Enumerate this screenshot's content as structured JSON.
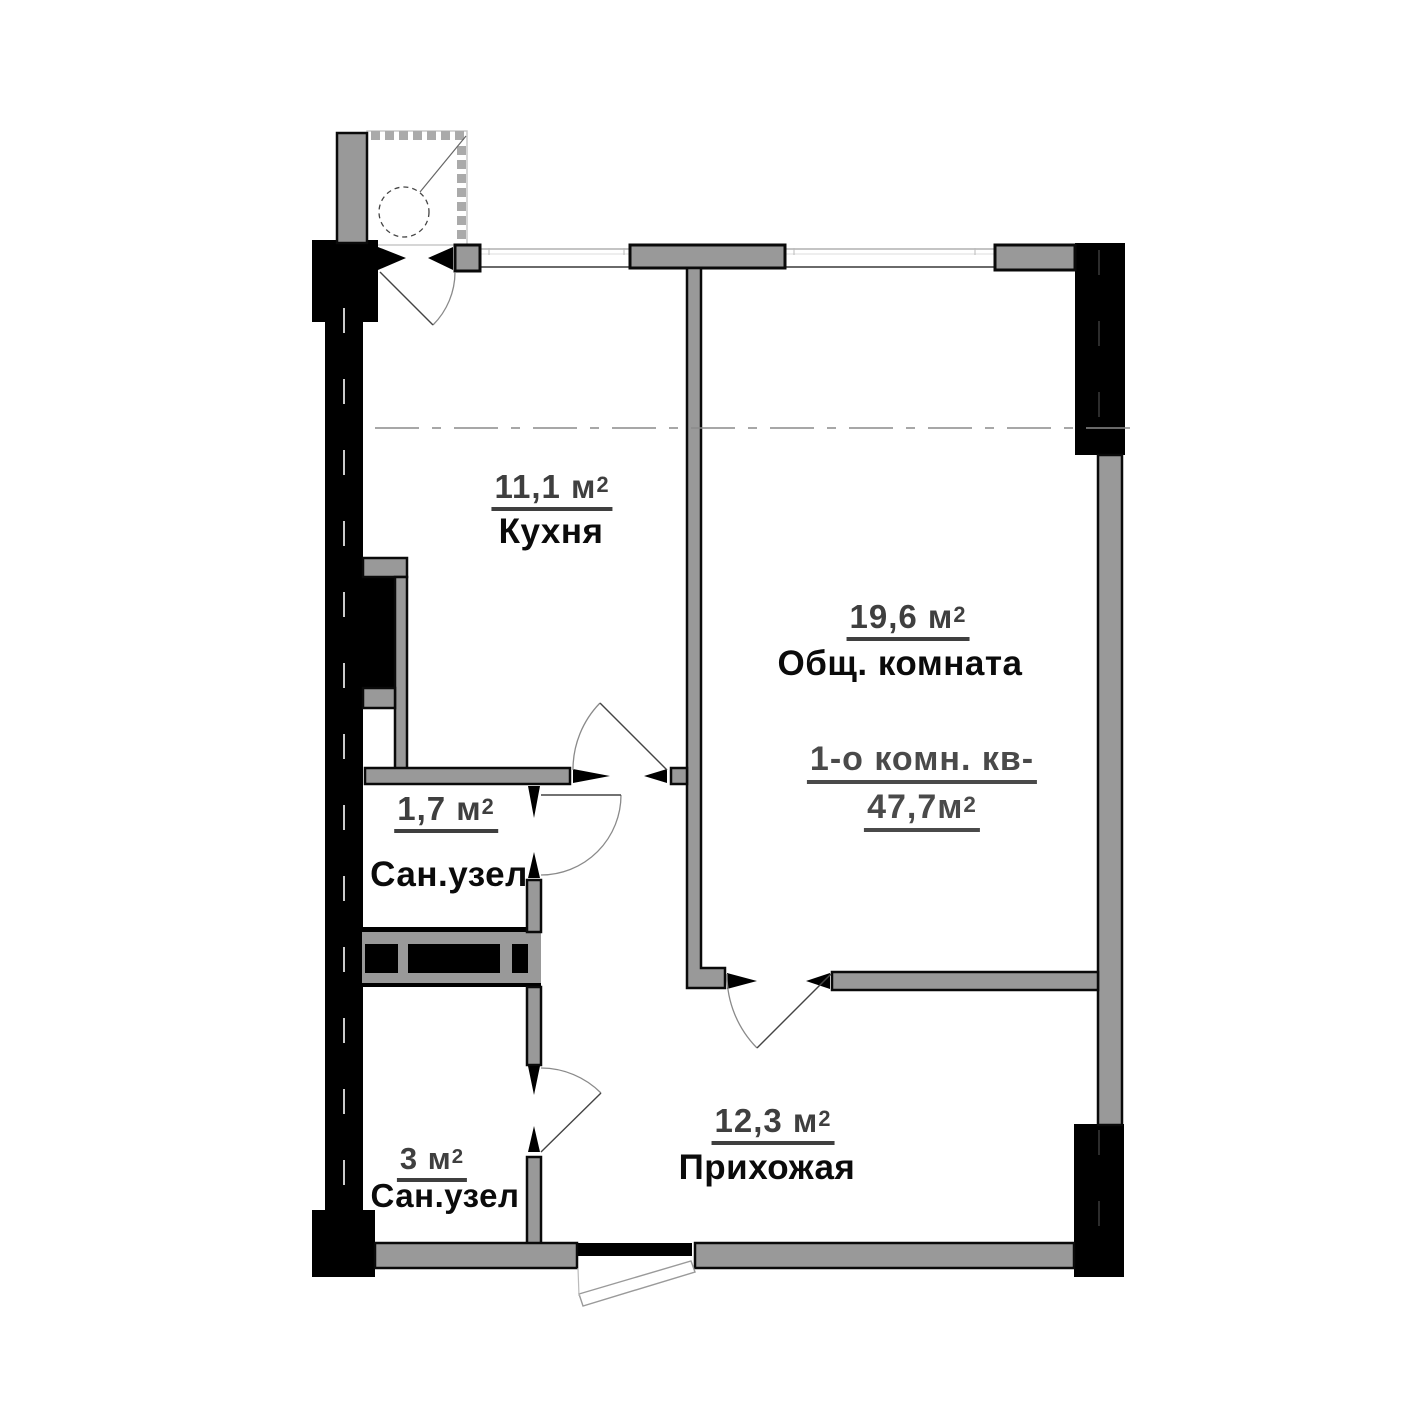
{
  "plan": {
    "type": "apartment-floor-plan",
    "apartment": {
      "title_line": "1-о комн. кв-",
      "total_area": "47,7м",
      "total_area_sup": "2"
    },
    "rooms": [
      {
        "id": "kitchen",
        "area": "11,1 м",
        "sup": "2",
        "name": "Кухня"
      },
      {
        "id": "living",
        "area": "19,6 м",
        "sup": "2",
        "name": "Общ. комната"
      },
      {
        "id": "bath1",
        "area": "1,7 м",
        "sup": "2",
        "name": "Сан.узел"
      },
      {
        "id": "bath2",
        "area": "3 м",
        "sup": "2",
        "name": "Сан.узел"
      },
      {
        "id": "hall",
        "area": "12,3 м",
        "sup": "2",
        "name": "Прихожая"
      }
    ],
    "colors": {
      "wall_fill": "#999999",
      "wall_outline": "#000000",
      "black_wall": "#000000",
      "balcony_dots": "#aaaaaa",
      "label_dark": "#0b0b0b",
      "label_gray": "#3f3f3f",
      "apartment_label_gray": "#4a4a4a",
      "door_arc": "#777777",
      "axis_line": "#8a8a8a"
    }
  }
}
